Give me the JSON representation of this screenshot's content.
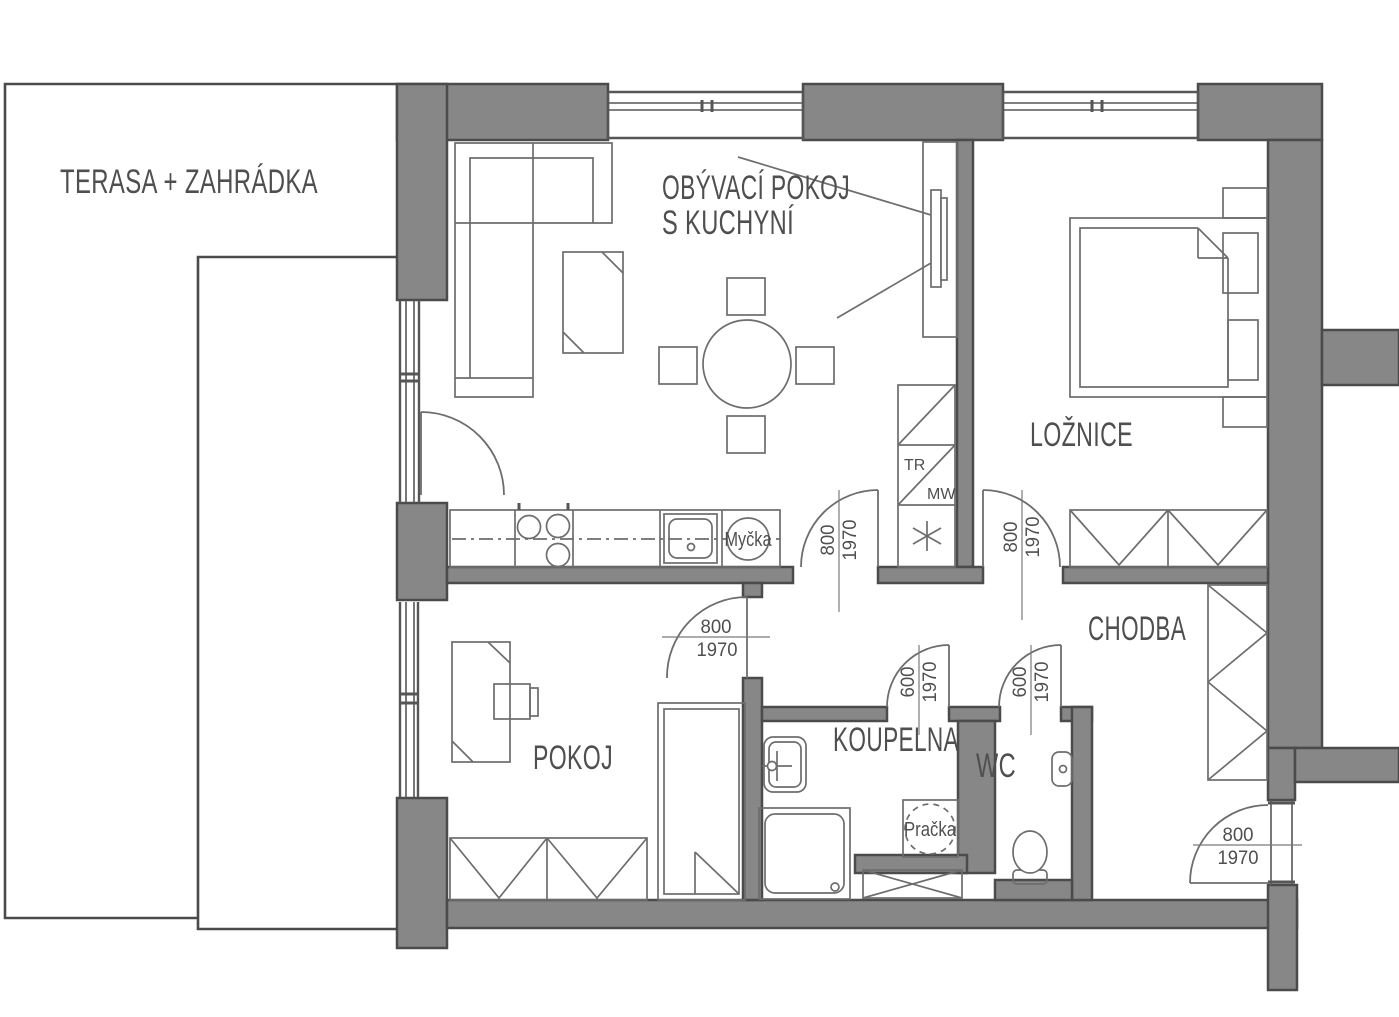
{
  "title": "Apartment floor plan",
  "colors": {
    "wall_fill": "#878787",
    "wall_stroke": "#4b4b4b",
    "furniture_line": "#6d6d6d",
    "text": "#4f4f4f",
    "background": "#ffffff"
  },
  "outdoor": {
    "label": "TERASA + ZAHRÁDKA"
  },
  "rooms": {
    "living": {
      "line1": "OBÝVACÍ POKOJ",
      "line2": "S KUCHYNÍ"
    },
    "bedroom": {
      "label": "LOŽNICE"
    },
    "hallway": {
      "label": "CHODBA"
    },
    "small_room": {
      "label": "POKOJ"
    },
    "bathroom": {
      "label": "KOUPELNA"
    },
    "wc": {
      "label": "WC"
    }
  },
  "appliances": {
    "dishwasher": {
      "label": "Myčka"
    },
    "washing_machine": {
      "label": "Pračka"
    },
    "tall_unit": {
      "top": "TR",
      "bottom": "MW"
    }
  },
  "doors": {
    "living_hall": {
      "width": "800",
      "height": "1970"
    },
    "bedroom": {
      "width": "800",
      "height": "1970"
    },
    "small_room": {
      "width": "800",
      "height": "1970"
    },
    "bathroom": {
      "width": "600",
      "height": "1970"
    },
    "wc": {
      "width": "600",
      "height": "1970"
    },
    "entry": {
      "width": "800",
      "height": "1970"
    }
  }
}
